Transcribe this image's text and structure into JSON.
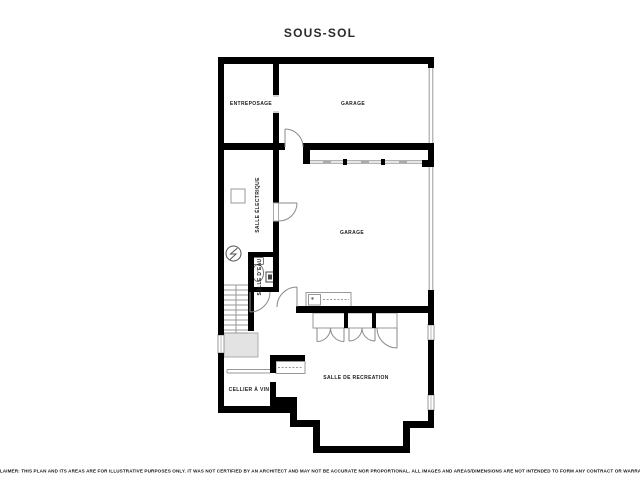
{
  "title": "SOUS-SOL",
  "rooms": {
    "entreposage": {
      "label": "ENTREPOSAGE"
    },
    "garage_upper": {
      "label": "GARAGE"
    },
    "salle_electrique": {
      "label": "SALLE ÉLECTRIQUE"
    },
    "garage_main": {
      "label": "GARAGE"
    },
    "salle_deau": {
      "label": "SALLE D'EAU"
    },
    "cellier": {
      "label": "CELLIER À VIN"
    },
    "salle_recreation": {
      "label": "SALLE DE RECREATION"
    }
  },
  "disclaimer": "DISCLAIMER: THIS PLAN AND ITS AREAS ARE FOR ILLUSTRATIVE PURPOSES ONLY. IT WAS NOT CERTIFIED BY AN ARCHITECT AND MAY NOT BE ACCURATE NOR PROPORTIONAL. ALL IMAGES AND AREAS/DIMENSIONS ARE NOT INTENDED TO FORM ANY CONTRACT OR WARRANTY.",
  "icons": {
    "electrical_symbol": "circle-lightning-icon",
    "toilet": "toilet-icon",
    "sink": "sink-icon",
    "stairs": "stairs-icon",
    "garage_door": "garage-door-band",
    "window": "window-band"
  },
  "colors": {
    "wall": "#000000",
    "thin_line": "#999999",
    "door_line": "#8a8a8a",
    "understair_fill": "#e3e3e3",
    "text": "#1c1c1c",
    "background": "#ffffff"
  }
}
